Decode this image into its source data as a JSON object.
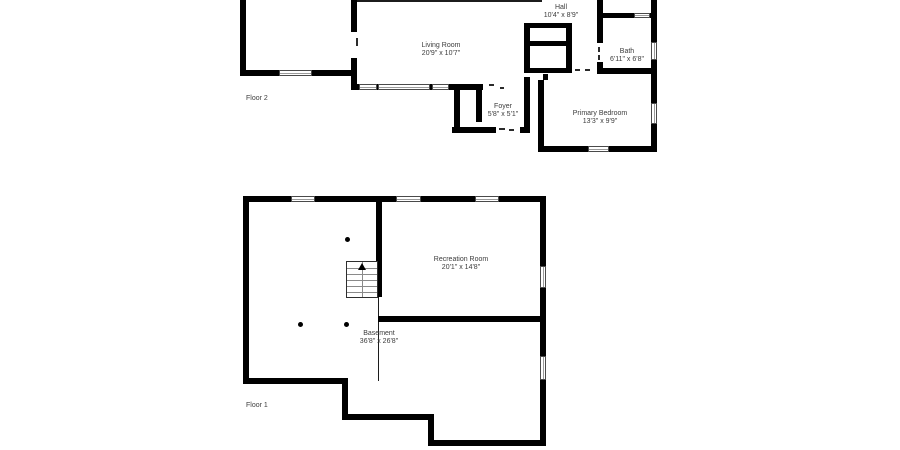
{
  "document": {
    "type": "floor-plan",
    "background": "#ffffff"
  },
  "colors": {
    "wall": "#000000",
    "text": "#3c3c3c",
    "window_border": "#4a4a4a",
    "window_fill": "#ffffff"
  },
  "floors": [
    {
      "label": "Floor 2",
      "rooms": [
        {
          "id": "cut_room",
          "name": "",
          "dims": "10'0\" x 10'4\""
        },
        {
          "id": "living_room",
          "name": "Living Room",
          "dims": "20'9\" x 10'7\""
        },
        {
          "id": "hall",
          "name": "Hall",
          "dims": "10'4\" x 8'9\""
        },
        {
          "id": "bath",
          "name": "Bath",
          "dims": "6'11\" x 6'8\""
        },
        {
          "id": "foyer",
          "name": "Foyer",
          "dims": "5'8\" x 5'1\""
        },
        {
          "id": "primary_bedroom",
          "name": "Primary Bedroom",
          "dims": "13'3\" x 9'9\""
        }
      ]
    },
    {
      "label": "Floor 1",
      "rooms": [
        {
          "id": "recreation_room",
          "name": "Recreation Room",
          "dims": "20'1\" x 14'8\""
        },
        {
          "id": "basement",
          "name": "Basement",
          "dims": "36'8\" x 26'8\""
        }
      ]
    }
  ]
}
